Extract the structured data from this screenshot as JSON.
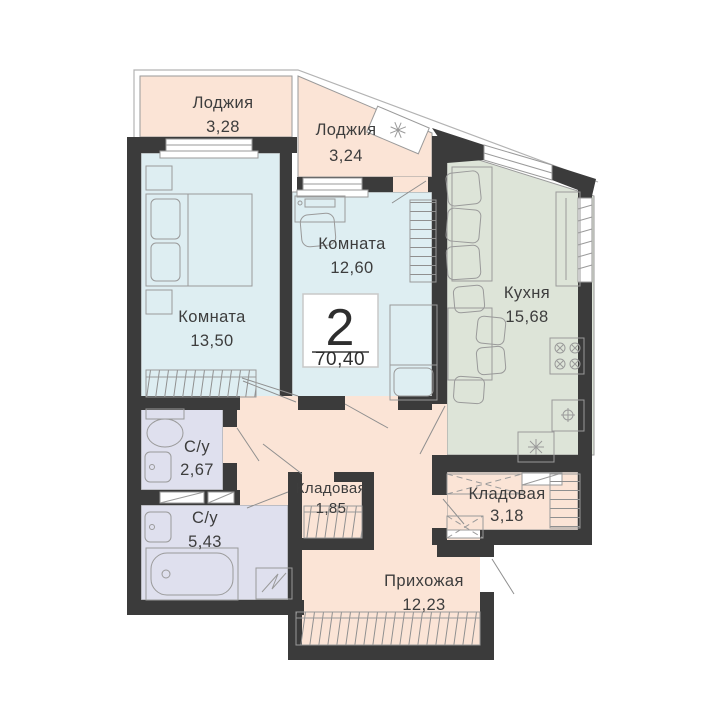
{
  "plan": {
    "type_label": "2",
    "total_area": "70,40",
    "rooms": [
      {
        "name": "Лоджия",
        "area": "3,28"
      },
      {
        "name": "Лоджия",
        "area": "3,24"
      },
      {
        "name": "Комната",
        "area": "12,60"
      },
      {
        "name": "Комната",
        "area": "13,50"
      },
      {
        "name": "Кухня",
        "area": "15,68"
      },
      {
        "name": "С/у",
        "area": "2,67"
      },
      {
        "name": "С/у",
        "area": "5,43"
      },
      {
        "name": "Кладовая",
        "area": "1,85"
      },
      {
        "name": "Кладовая",
        "area": "3,18"
      },
      {
        "name": "Прихожая",
        "area": "12,23"
      }
    ],
    "colors": {
      "wall": "#3b3b3b",
      "loggia": "#fbe4d6",
      "room": "#deeef2",
      "kitchen": "#dde4d8",
      "bath": "#dfe0ee",
      "line": "#9a9a9a",
      "text": "#3d3d3d",
      "paper": "#ffffff"
    },
    "fixtures": [
      "double-bed",
      "nightstand",
      "wardrobe",
      "desk",
      "office-chair",
      "sofa",
      "dining-table",
      "chair",
      "fridge",
      "stove",
      "kitchen-sink",
      "counter",
      "toilet",
      "washbasin",
      "bathtub",
      "washing-machine",
      "air-conditioner",
      "entrance-door",
      "window"
    ]
  }
}
